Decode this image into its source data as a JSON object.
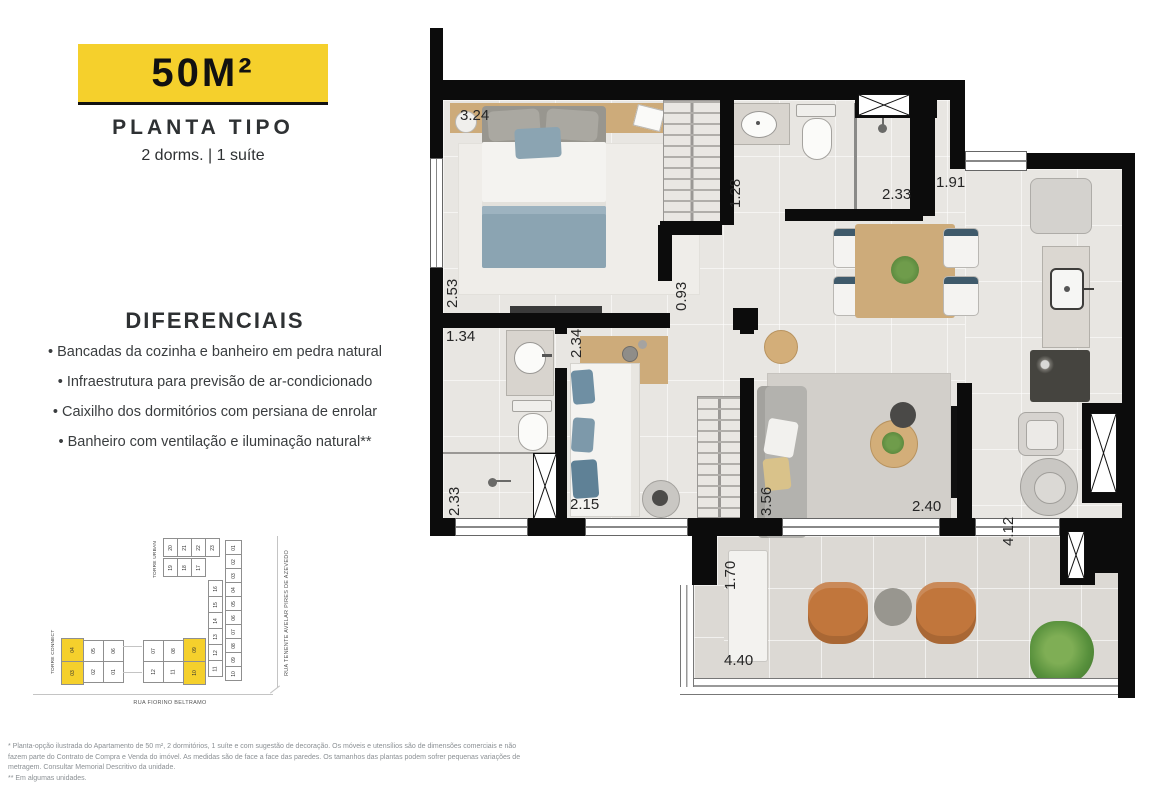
{
  "header": {
    "area_badge": "50M²",
    "title": "PLANTA TIPO",
    "subtitle": "2 dorms. | 1 suíte"
  },
  "diferenciais": {
    "title": "DIFERENCIAIS",
    "items": [
      "Bancadas da cozinha e banheiro em pedra natural",
      "Infraestrutura para previsão de ar-condicionado",
      "Caixilho dos dormitórios com persiana de enrolar",
      "Banheiro com ventilação e iluminação natural**"
    ]
  },
  "site_plan": {
    "torre_connect_label": "TORRE CONNECT",
    "torre_urban_label": "TORRE URBAN",
    "street_right": "RUA TENENTE AVELAR PIRES DE AZEVEDO",
    "street_bottom": "RUA FIORINO BELTRAMO",
    "connect_top": [
      "04",
      "05",
      "06",
      "07",
      "08",
      "09"
    ],
    "connect_bottom": [
      "03",
      "02",
      "01",
      "12",
      "11",
      "10"
    ],
    "urban_row_a": [
      "20",
      "21",
      "22",
      "23"
    ],
    "urban_row_b": [
      "19",
      "18",
      "17"
    ],
    "urban_col_inner": [
      "16",
      "15",
      "14",
      "13",
      "12",
      "11"
    ],
    "urban_col_outer": [
      "01",
      "02",
      "03",
      "04",
      "05",
      "06",
      "07",
      "08",
      "09",
      "10"
    ]
  },
  "floor_plan": {
    "dims": {
      "suite_width": "3.24",
      "suite_depth": "2.53",
      "bath1_width": "1.28",
      "bath1_shower": "2.33",
      "kitchen_width": "1.91",
      "hall_width": "0.93",
      "bath2_width": "1.34",
      "dorm2_width": "2.34",
      "bath2_shower": "2.33",
      "dorm2_length": "2.15",
      "living_depth": "3.56",
      "living_width": "2.40",
      "kitchen_depth": "4.12",
      "balcony_depth": "1.70",
      "balcony_width": "4.40"
    }
  },
  "footnotes": {
    "line1": "* Planta-opção ilustrada do Apartamento de 50 m², 2 dormitórios, 1 suíte e com sugestão de decoração. Os móveis e utensílios são de dimensões comerciais e não fazem parte do Contrato de Compra e Venda do imóvel. As medidas são de face a face das paredes. Os tamanhos das plantas podem sofrer pequenas variações de metragem. Consultar Memorial Descritivo da unidade.",
    "line2": "** Em algumas unidades."
  },
  "colors": {
    "accent_yellow": "#F5D02C",
    "wall_black": "#0C0C0C"
  }
}
